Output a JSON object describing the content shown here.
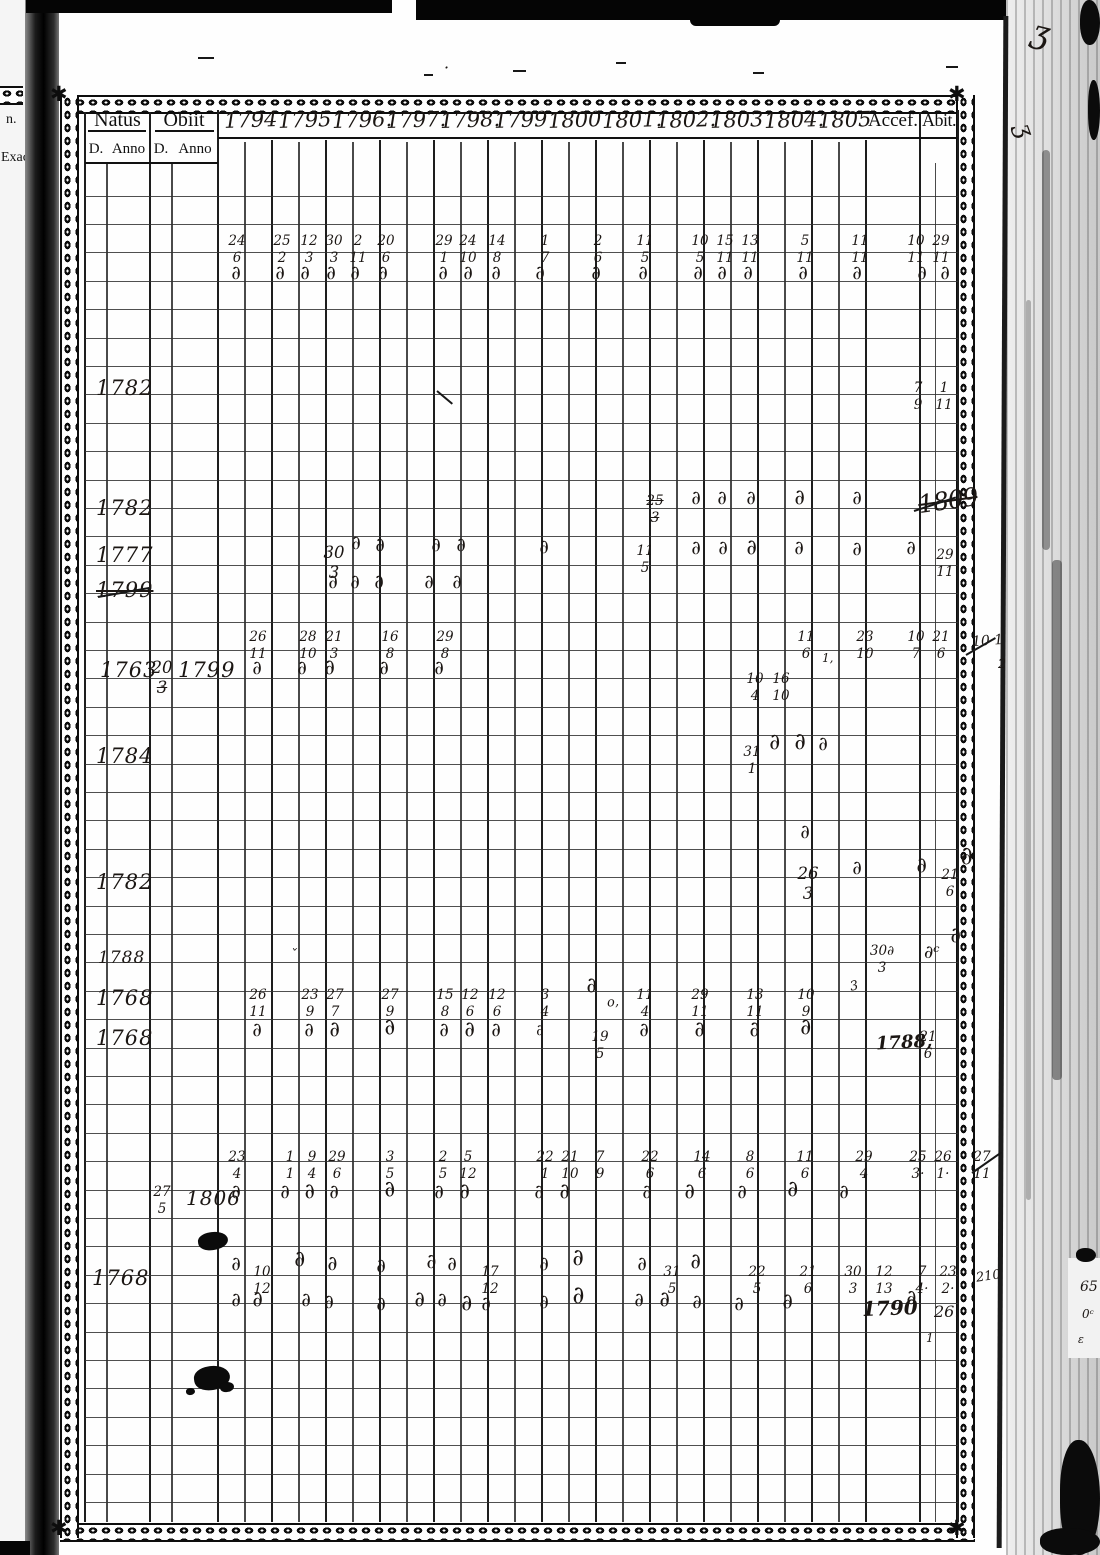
{
  "prev_page": {
    "edge_text_top": "n.",
    "edge_text_bottom": "Exact"
  },
  "ink_color": "#1b1613",
  "header": {
    "natus": "Natus",
    "obiit": "Obiit",
    "sub": [
      "D.",
      "Anno",
      "D.",
      "Anno"
    ],
    "years": [
      "1794",
      "1795",
      "1796.",
      "1797.",
      "1798.",
      "1799",
      "1800",
      "1801.",
      "1802.",
      "1803",
      "1804.",
      "1805"
    ],
    "accessit": "Accef.",
    "abiit": "Abit."
  },
  "entries": [
    {
      "k": "l",
      "x": 198,
      "y": 57,
      "w": 16
    },
    {
      "k": "l",
      "x": 424,
      "y": 74,
      "w": 9
    },
    {
      "k": "t",
      "x": 444,
      "y": 60,
      "v": "·",
      "s": 16
    },
    {
      "k": "l",
      "x": 513,
      "y": 70,
      "w": 13
    },
    {
      "k": "l",
      "x": 616,
      "y": 62,
      "w": 10
    },
    {
      "k": "l",
      "x": 753,
      "y": 72,
      "w": 11
    },
    {
      "k": "l",
      "x": 946,
      "y": 66,
      "w": 12
    },
    {
      "k": "t",
      "x": 1032,
      "y": 16,
      "v": "ʒ",
      "s": 32,
      "r": 14
    },
    {
      "k": "t",
      "x": 1018,
      "y": 118,
      "v": "ʒ",
      "s": 24,
      "r": 70
    },
    {
      "k": "f",
      "x": 237,
      "y": 252,
      "t": "24",
      "b": "6"
    },
    {
      "k": "f",
      "x": 282,
      "y": 252,
      "t": "25",
      "b": "2"
    },
    {
      "k": "f",
      "x": 309,
      "y": 252,
      "t": "12",
      "b": "3"
    },
    {
      "k": "f",
      "x": 334,
      "y": 252,
      "t": "30",
      "b": "3"
    },
    {
      "k": "f",
      "x": 358,
      "y": 252,
      "t": "2",
      "b": "11"
    },
    {
      "k": "f",
      "x": 386,
      "y": 252,
      "t": "20",
      "b": "6"
    },
    {
      "k": "f",
      "x": 444,
      "y": 252,
      "t": "29",
      "b": "1"
    },
    {
      "k": "f",
      "x": 468,
      "y": 252,
      "t": "24",
      "b": "10"
    },
    {
      "k": "f",
      "x": 497,
      "y": 252,
      "t": "14",
      "b": "8"
    },
    {
      "k": "f",
      "x": 545,
      "y": 252,
      "t": "1",
      "b": "7"
    },
    {
      "k": "f",
      "x": 598,
      "y": 252,
      "t": "2",
      "b": "6"
    },
    {
      "k": "f",
      "x": 645,
      "y": 252,
      "t": "11",
      "b": "5"
    },
    {
      "k": "f",
      "x": 700,
      "y": 252,
      "t": "10",
      "b": "5"
    },
    {
      "k": "f",
      "x": 725,
      "y": 252,
      "t": "15",
      "b": "11"
    },
    {
      "k": "f",
      "x": 750,
      "y": 252,
      "t": "13",
      "b": "11"
    },
    {
      "k": "f",
      "x": 805,
      "y": 252,
      "t": "5",
      "b": "11"
    },
    {
      "k": "f",
      "x": 860,
      "y": 252,
      "t": "11",
      "b": "11"
    },
    {
      "k": "f",
      "x": 916,
      "y": 252,
      "t": "10",
      "b": "11"
    },
    {
      "k": "f",
      "x": 941,
      "y": 252,
      "t": "29",
      "b": "11"
    },
    {
      "k": "d",
      "x": 237,
      "y": 281
    },
    {
      "k": "d",
      "x": 281,
      "y": 281
    },
    {
      "k": "d",
      "x": 306,
      "y": 281
    },
    {
      "k": "d",
      "x": 332,
      "y": 281
    },
    {
      "k": "d",
      "x": 356,
      "y": 281
    },
    {
      "k": "d",
      "x": 384,
      "y": 281
    },
    {
      "k": "d",
      "x": 444,
      "y": 281
    },
    {
      "k": "d",
      "x": 469,
      "y": 281
    },
    {
      "k": "d",
      "x": 497,
      "y": 281
    },
    {
      "k": "d",
      "x": 541,
      "y": 281
    },
    {
      "k": "d",
      "x": 597,
      "y": 281
    },
    {
      "k": "d",
      "x": 644,
      "y": 281
    },
    {
      "k": "d",
      "x": 699,
      "y": 281
    },
    {
      "k": "d",
      "x": 723,
      "y": 281
    },
    {
      "k": "d",
      "x": 749,
      "y": 281
    },
    {
      "k": "d",
      "x": 804,
      "y": 281
    },
    {
      "k": "d",
      "x": 858,
      "y": 281
    },
    {
      "k": "d",
      "x": 923,
      "y": 281
    },
    {
      "k": "d",
      "x": 946,
      "y": 281
    },
    {
      "k": "t",
      "x": 96,
      "y": 378,
      "v": "1782",
      "c": "yr"
    },
    {
      "k": "f",
      "x": 918,
      "y": 399,
      "t": "7",
      "b": "9"
    },
    {
      "k": "f",
      "x": 944,
      "y": 399,
      "t": "1",
      "b": "11"
    },
    {
      "k": "l",
      "x": 437,
      "y": 390,
      "w": 20,
      "r": 40
    },
    {
      "k": "t",
      "x": 96,
      "y": 498,
      "v": "1782",
      "c": "yr"
    },
    {
      "k": "f",
      "x": 655,
      "y": 512,
      "t": "25",
      "b": "3",
      "st": "tb"
    },
    {
      "k": "d",
      "x": 697,
      "y": 506
    },
    {
      "k": "d",
      "x": 723,
      "y": 506
    },
    {
      "k": "d",
      "x": 752,
      "y": 506
    },
    {
      "k": "d",
      "x": 800,
      "y": 504,
      "s": 21
    },
    {
      "k": "d",
      "x": 858,
      "y": 506
    },
    {
      "k": "t",
      "x": 918,
      "y": 488,
      "v": "1809",
      "c": "scrib"
    },
    {
      "k": "l",
      "x": 914,
      "y": 510,
      "w": 44,
      "r": -18
    },
    {
      "k": "t",
      "x": 96,
      "y": 545,
      "v": "1777",
      "c": "yr"
    },
    {
      "k": "f",
      "x": 334,
      "y": 565,
      "t": "30",
      "b": "3",
      "big": 1
    },
    {
      "k": "d",
      "x": 357,
      "y": 551
    },
    {
      "k": "d",
      "x": 381,
      "y": 553
    },
    {
      "k": "d",
      "x": 437,
      "y": 553
    },
    {
      "k": "d",
      "x": 462,
      "y": 553
    },
    {
      "k": "d",
      "x": 545,
      "y": 555
    },
    {
      "k": "f",
      "x": 645,
      "y": 562,
      "t": "11",
      "b": "5"
    },
    {
      "k": "d",
      "x": 697,
      "y": 556
    },
    {
      "k": "d",
      "x": 724,
      "y": 556
    },
    {
      "k": "d",
      "x": 752,
      "y": 554,
      "s": 21
    },
    {
      "k": "d",
      "x": 800,
      "y": 556
    },
    {
      "k": "d",
      "x": 858,
      "y": 557
    },
    {
      "k": "d",
      "x": 912,
      "y": 556
    },
    {
      "k": "f",
      "x": 945,
      "y": 566,
      "t": "29",
      "b": "11"
    },
    {
      "k": "t",
      "x": 96,
      "y": 580,
      "v": "1799",
      "c": "yr",
      "st": "t"
    },
    {
      "k": "l",
      "x": 98,
      "y": 596,
      "w": 54,
      "r": -10
    },
    {
      "k": "d",
      "x": 334,
      "y": 590
    },
    {
      "k": "d",
      "x": 356,
      "y": 590
    },
    {
      "k": "d",
      "x": 380,
      "y": 590
    },
    {
      "k": "d",
      "x": 430,
      "y": 590
    },
    {
      "k": "d",
      "x": 458,
      "y": 590
    },
    {
      "k": "f",
      "x": 258,
      "y": 648,
      "t": "26",
      "b": "11"
    },
    {
      "k": "f",
      "x": 308,
      "y": 648,
      "t": "28",
      "b": "10"
    },
    {
      "k": "f",
      "x": 334,
      "y": 648,
      "t": "21",
      "b": "3"
    },
    {
      "k": "f",
      "x": 390,
      "y": 648,
      "t": "16",
      "b": "8"
    },
    {
      "k": "f",
      "x": 445,
      "y": 648,
      "t": "29",
      "b": "8"
    },
    {
      "k": "f",
      "x": 806,
      "y": 648,
      "t": "11",
      "b": "6"
    },
    {
      "k": "t",
      "x": 822,
      "y": 652,
      "v": "1,",
      "s": 12
    },
    {
      "k": "f",
      "x": 865,
      "y": 648,
      "t": "23",
      "b": "10"
    },
    {
      "k": "f",
      "x": 916,
      "y": 648,
      "t": "10",
      "b": "7"
    },
    {
      "k": "f",
      "x": 941,
      "y": 648,
      "t": "21",
      "b": "6"
    },
    {
      "k": "t",
      "x": 972,
      "y": 634,
      "v": "10 1",
      "s": 14,
      "r": -4
    },
    {
      "k": "t",
      "x": 998,
      "y": 658,
      "v": "2",
      "s": 13
    },
    {
      "k": "l",
      "x": 966,
      "y": 654,
      "w": 34,
      "r": -30
    },
    {
      "k": "t",
      "x": 100,
      "y": 660,
      "v": "1763",
      "c": "yr"
    },
    {
      "k": "f",
      "x": 162,
      "y": 680,
      "t": "20",
      "b": "3",
      "big": 1,
      "st": "b"
    },
    {
      "k": "t",
      "x": 178,
      "y": 660,
      "v": "1799",
      "c": "yr"
    },
    {
      "k": "d",
      "x": 258,
      "y": 676
    },
    {
      "k": "d",
      "x": 303,
      "y": 676
    },
    {
      "k": "d",
      "x": 330,
      "y": 674,
      "s": 21
    },
    {
      "k": "d",
      "x": 385,
      "y": 676
    },
    {
      "k": "d",
      "x": 440,
      "y": 676
    },
    {
      "k": "f",
      "x": 755,
      "y": 690,
      "t": "10",
      "b": "4"
    },
    {
      "k": "f",
      "x": 781,
      "y": 690,
      "t": "16",
      "b": "10"
    },
    {
      "k": "t",
      "x": 96,
      "y": 746,
      "v": "1784",
      "c": "yr"
    },
    {
      "k": "f",
      "x": 752,
      "y": 763,
      "t": "31",
      "b": "1"
    },
    {
      "k": "d",
      "x": 775,
      "y": 749,
      "s": 22
    },
    {
      "k": "d",
      "x": 800,
      "y": 748,
      "s": 23
    },
    {
      "k": "d",
      "x": 824,
      "y": 752
    },
    {
      "k": "d",
      "x": 806,
      "y": 840
    },
    {
      "k": "t",
      "x": 96,
      "y": 872,
      "v": "1782",
      "c": "yr"
    },
    {
      "k": "f",
      "x": 808,
      "y": 886,
      "t": "26",
      "b": "3",
      "big": 1
    },
    {
      "k": "d",
      "x": 858,
      "y": 876
    },
    {
      "k": "d",
      "x": 922,
      "y": 872,
      "s": 21
    },
    {
      "k": "f",
      "x": 950,
      "y": 886,
      "t": "21",
      "b": "6"
    },
    {
      "k": "d",
      "x": 966,
      "y": 860,
      "s": 25
    },
    {
      "k": "t",
      "x": 98,
      "y": 950,
      "v": "1788",
      "c": "yr",
      "s": 17
    },
    {
      "k": "t",
      "x": 290,
      "y": 948,
      "v": "ˇ",
      "s": 14
    },
    {
      "k": "f",
      "x": 882,
      "y": 962,
      "t": "30∂",
      "b": "3"
    },
    {
      "k": "t",
      "x": 924,
      "y": 944,
      "v": "∂ᶜ",
      "s": 18
    },
    {
      "k": "d",
      "x": 956,
      "y": 942,
      "s": 21
    },
    {
      "k": "t",
      "x": 96,
      "y": 988,
      "v": "1768",
      "c": "yr"
    },
    {
      "k": "f",
      "x": 258,
      "y": 1006,
      "t": "26",
      "b": "11"
    },
    {
      "k": "f",
      "x": 310,
      "y": 1006,
      "t": "23",
      "b": "9"
    },
    {
      "k": "f",
      "x": 335,
      "y": 1006,
      "t": "27",
      "b": "7"
    },
    {
      "k": "f",
      "x": 390,
      "y": 1006,
      "t": "27",
      "b": "9"
    },
    {
      "k": "f",
      "x": 445,
      "y": 1006,
      "t": "15",
      "b": "8"
    },
    {
      "k": "f",
      "x": 470,
      "y": 1006,
      "t": "12",
      "b": "6"
    },
    {
      "k": "f",
      "x": 497,
      "y": 1006,
      "t": "12",
      "b": "6"
    },
    {
      "k": "f",
      "x": 545,
      "y": 1006,
      "t": "3",
      "b": "4"
    },
    {
      "k": "d",
      "x": 592,
      "y": 992,
      "s": 21
    },
    {
      "k": "t",
      "x": 607,
      "y": 996,
      "v": "o,",
      "s": 13,
      "r": -6
    },
    {
      "k": "f",
      "x": 645,
      "y": 1006,
      "t": "11",
      "b": "4"
    },
    {
      "k": "f",
      "x": 700,
      "y": 1006,
      "t": "29",
      "b": "11"
    },
    {
      "k": "f",
      "x": 755,
      "y": 1006,
      "t": "13",
      "b": "11"
    },
    {
      "k": "f",
      "x": 806,
      "y": 1006,
      "t": "10",
      "b": "9"
    },
    {
      "k": "t",
      "x": 850,
      "y": 980,
      "v": "3",
      "s": 13,
      "r": -12
    },
    {
      "k": "t",
      "x": 96,
      "y": 1028,
      "v": "1768",
      "c": "yr"
    },
    {
      "k": "d",
      "x": 258,
      "y": 1038
    },
    {
      "k": "d",
      "x": 310,
      "y": 1038
    },
    {
      "k": "d",
      "x": 335,
      "y": 1036,
      "s": 21
    },
    {
      "k": "d",
      "x": 390,
      "y": 1034,
      "s": 22,
      "r": -14
    },
    {
      "k": "d",
      "x": 445,
      "y": 1038
    },
    {
      "k": "d",
      "x": 470,
      "y": 1036,
      "s": 21
    },
    {
      "k": "d",
      "x": 497,
      "y": 1038
    },
    {
      "k": "d",
      "x": 542,
      "y": 1040,
      "s": 15
    },
    {
      "k": "f",
      "x": 600,
      "y": 1048,
      "t": "19",
      "b": "5"
    },
    {
      "k": "d",
      "x": 645,
      "y": 1038
    },
    {
      "k": "d",
      "x": 700,
      "y": 1036,
      "s": 21
    },
    {
      "k": "d",
      "x": 755,
      "y": 1036,
      "s": 21
    },
    {
      "k": "d",
      "x": 806,
      "y": 1034,
      "s": 22
    },
    {
      "k": "t",
      "x": 876,
      "y": 1034,
      "v": "1788,",
      "c": "yr2",
      "s": 18,
      "r": -3
    },
    {
      "k": "f",
      "x": 928,
      "y": 1048,
      "t": "21",
      "b": "6"
    },
    {
      "k": "f",
      "x": 237,
      "y": 1168,
      "t": "23",
      "b": "4"
    },
    {
      "k": "f",
      "x": 290,
      "y": 1168,
      "t": "1",
      "b": "1"
    },
    {
      "k": "f",
      "x": 312,
      "y": 1168,
      "t": "9",
      "b": "4"
    },
    {
      "k": "f",
      "x": 337,
      "y": 1168,
      "t": "29",
      "b": "6"
    },
    {
      "k": "f",
      "x": 390,
      "y": 1168,
      "t": "3",
      "b": "5"
    },
    {
      "k": "f",
      "x": 443,
      "y": 1168,
      "t": "2",
      "b": "5"
    },
    {
      "k": "f",
      "x": 468,
      "y": 1168,
      "t": "5",
      "b": "12"
    },
    {
      "k": "f",
      "x": 545,
      "y": 1168,
      "t": "22",
      "b": "1"
    },
    {
      "k": "f",
      "x": 570,
      "y": 1168,
      "t": "21",
      "b": "10"
    },
    {
      "k": "f",
      "x": 600,
      "y": 1168,
      "t": "7",
      "b": "9"
    },
    {
      "k": "f",
      "x": 650,
      "y": 1168,
      "t": "22",
      "b": "6"
    },
    {
      "k": "f",
      "x": 702,
      "y": 1168,
      "t": "14",
      "b": "6"
    },
    {
      "k": "f",
      "x": 750,
      "y": 1168,
      "t": "8",
      "b": "6"
    },
    {
      "k": "f",
      "x": 805,
      "y": 1168,
      "t": "11",
      "b": "6"
    },
    {
      "k": "f",
      "x": 864,
      "y": 1168,
      "t": "29",
      "b": "4"
    },
    {
      "k": "f",
      "x": 918,
      "y": 1168,
      "t": "25",
      "b": "3·"
    },
    {
      "k": "f",
      "x": 943,
      "y": 1168,
      "t": "26",
      "b": "1·"
    },
    {
      "k": "f",
      "x": 982,
      "y": 1168,
      "t": "27",
      "b": "11"
    },
    {
      "k": "l",
      "x": 972,
      "y": 1172,
      "w": 36,
      "r": -35
    },
    {
      "k": "f",
      "x": 162,
      "y": 1203,
      "t": "27",
      "b": "5"
    },
    {
      "k": "t",
      "x": 186,
      "y": 1188,
      "v": "1806",
      "c": "yr",
      "s": 20
    },
    {
      "k": "d",
      "x": 237,
      "y": 1200
    },
    {
      "k": "d",
      "x": 286,
      "y": 1200
    },
    {
      "k": "d",
      "x": 310,
      "y": 1198,
      "s": 21,
      "r": -12
    },
    {
      "k": "d",
      "x": 335,
      "y": 1200
    },
    {
      "k": "d",
      "x": 390,
      "y": 1196,
      "s": 22,
      "r": -14
    },
    {
      "k": "d",
      "x": 440,
      "y": 1200
    },
    {
      "k": "d",
      "x": 465,
      "y": 1198,
      "s": 21
    },
    {
      "k": "d",
      "x": 540,
      "y": 1200
    },
    {
      "k": "d",
      "x": 565,
      "y": 1198,
      "s": 21
    },
    {
      "k": "d",
      "x": 648,
      "y": 1200
    },
    {
      "k": "d",
      "x": 690,
      "y": 1198,
      "s": 21
    },
    {
      "k": "d",
      "x": 743,
      "y": 1200
    },
    {
      "k": "d",
      "x": 793,
      "y": 1196,
      "s": 22
    },
    {
      "k": "d",
      "x": 845,
      "y": 1200
    },
    {
      "k": "b",
      "x": 198,
      "y": 1232,
      "w": 30,
      "h": 18
    },
    {
      "k": "t",
      "x": 92,
      "y": 1268,
      "v": "1768",
      "c": "yr"
    },
    {
      "k": "d",
      "x": 237,
      "y": 1272
    },
    {
      "k": "f",
      "x": 262,
      "y": 1283,
      "t": "10",
      "b": "12"
    },
    {
      "k": "d",
      "x": 300,
      "y": 1266,
      "s": 22
    },
    {
      "k": "d",
      "x": 333,
      "y": 1270,
      "s": 20
    },
    {
      "k": "d",
      "x": 382,
      "y": 1274
    },
    {
      "k": "d",
      "x": 432,
      "y": 1268,
      "s": 20
    },
    {
      "k": "d",
      "x": 453,
      "y": 1272
    },
    {
      "k": "f",
      "x": 490,
      "y": 1283,
      "t": "17",
      "b": "12"
    },
    {
      "k": "d",
      "x": 545,
      "y": 1272
    },
    {
      "k": "d",
      "x": 578,
      "y": 1264,
      "s": 23
    },
    {
      "k": "d",
      "x": 643,
      "y": 1272
    },
    {
      "k": "f",
      "x": 672,
      "y": 1283,
      "t": "31",
      "b": "5"
    },
    {
      "k": "d",
      "x": 696,
      "y": 1268,
      "s": 21
    },
    {
      "k": "f",
      "x": 757,
      "y": 1283,
      "t": "22",
      "b": "5"
    },
    {
      "k": "f",
      "x": 808,
      "y": 1283,
      "t": "21",
      "b": "6"
    },
    {
      "k": "f",
      "x": 853,
      "y": 1283,
      "t": "30",
      "b": "3"
    },
    {
      "k": "f",
      "x": 884,
      "y": 1283,
      "t": "12",
      "b": "13"
    },
    {
      "k": "f",
      "x": 922,
      "y": 1283,
      "t": "7",
      "b": "4·"
    },
    {
      "k": "f",
      "x": 948,
      "y": 1283,
      "t": "23",
      "b": "2·"
    },
    {
      "k": "t",
      "x": 976,
      "y": 1270,
      "v": "210",
      "s": 13,
      "r": -8
    },
    {
      "k": "t",
      "x": 1080,
      "y": 1280,
      "v": "65",
      "s": 14
    },
    {
      "k": "t",
      "x": 1082,
      "y": 1308,
      "v": "0ᶜ",
      "s": 12
    },
    {
      "k": "t",
      "x": 1078,
      "y": 1334,
      "v": "ε",
      "s": 11
    },
    {
      "k": "d",
      "x": 237,
      "y": 1308
    },
    {
      "k": "d",
      "x": 258,
      "y": 1306,
      "s": 21
    },
    {
      "k": "d",
      "x": 307,
      "y": 1308
    },
    {
      "k": "d",
      "x": 330,
      "y": 1310
    },
    {
      "k": "d",
      "x": 382,
      "y": 1312
    },
    {
      "k": "d",
      "x": 420,
      "y": 1306,
      "s": 21
    },
    {
      "k": "d",
      "x": 443,
      "y": 1308
    },
    {
      "k": "d",
      "x": 467,
      "y": 1310,
      "s": 22
    },
    {
      "k": "d",
      "x": 487,
      "y": 1312
    },
    {
      "k": "d",
      "x": 545,
      "y": 1310
    },
    {
      "k": "d",
      "x": 578,
      "y": 1300,
      "s": 24
    },
    {
      "k": "d",
      "x": 640,
      "y": 1308
    },
    {
      "k": "d",
      "x": 665,
      "y": 1306,
      "s": 21
    },
    {
      "k": "d",
      "x": 698,
      "y": 1310
    },
    {
      "k": "d",
      "x": 740,
      "y": 1312
    },
    {
      "k": "d",
      "x": 788,
      "y": 1308,
      "s": 21
    },
    {
      "k": "t",
      "x": 862,
      "y": 1298,
      "v": "1790",
      "c": "yr2",
      "s": 20,
      "r": -2
    },
    {
      "k": "d",
      "x": 912,
      "y": 1304,
      "s": 20
    },
    {
      "k": "t",
      "x": 934,
      "y": 1304,
      "v": "26.",
      "s": 16
    },
    {
      "k": "t",
      "x": 926,
      "y": 1332,
      "v": "1",
      "s": 12
    },
    {
      "k": "b",
      "x": 194,
      "y": 1366,
      "w": 36,
      "h": 24
    },
    {
      "k": "b",
      "x": 220,
      "y": 1382,
      "w": 14,
      "h": 10
    },
    {
      "k": "b",
      "x": 186,
      "y": 1388,
      "w": 9,
      "h": 7
    }
  ]
}
